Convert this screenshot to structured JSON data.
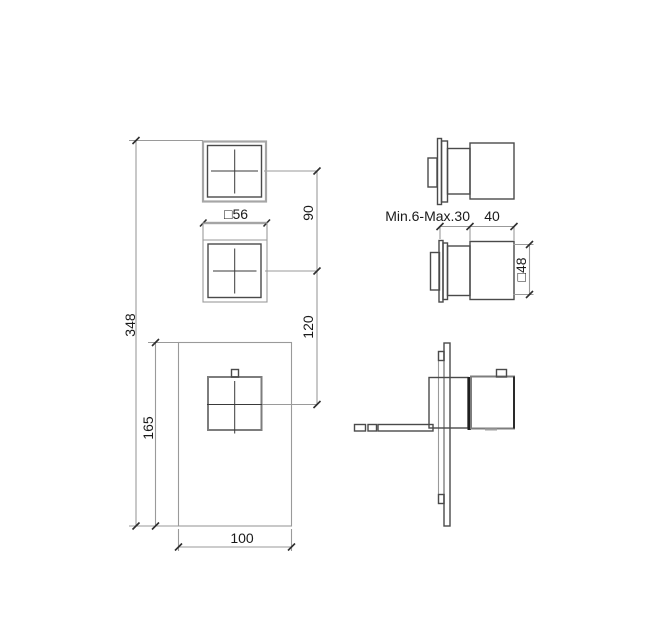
{
  "drawing": {
    "labels": {
      "total_height": "348",
      "plate_height": "165",
      "plate_width": "100",
      "handle_size": "□56",
      "upper_spacing": "90",
      "lower_spacing": "120",
      "mount_depth_range": "Min.6-Max.30",
      "handle_depth": "40",
      "base_size": "□48"
    },
    "colors": {
      "object_outline": "#4a4a4a",
      "light_outline": "#a6a6a6",
      "dimension_line": "#9a9a9a",
      "tick": "#2e2e2e",
      "text": "#1a1a1a",
      "seam": "#1f1f1f",
      "background": "#ffffff"
    }
  }
}
